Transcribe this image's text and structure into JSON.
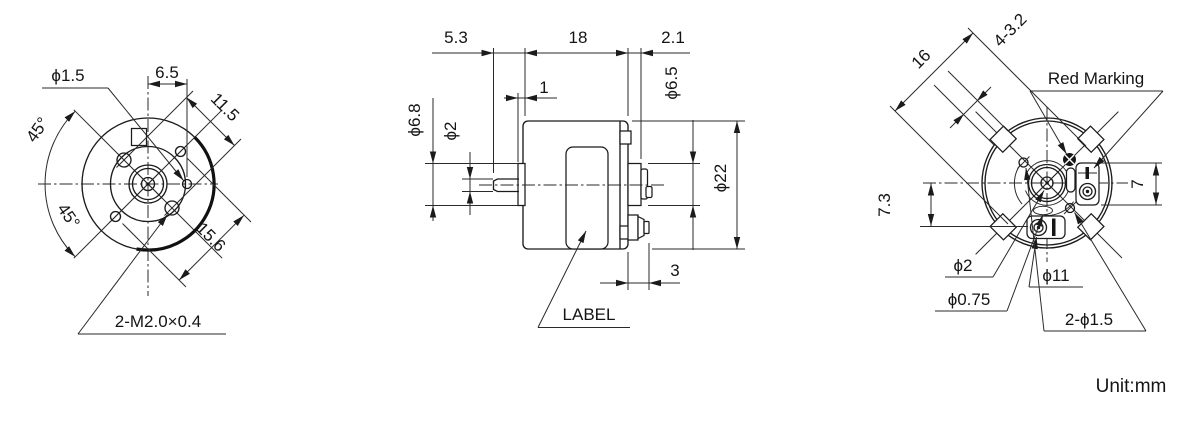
{
  "unit_note": "Unit:mm",
  "front_view": {
    "hole_dia": "ϕ1.5",
    "hole_offset": "6.5",
    "screw_circle": "11.5",
    "angle_upper": "45°",
    "angle_lower": "45°",
    "hole_circle": "15.6",
    "screw_thread": "2-M2.0×0.4"
  },
  "side_view": {
    "shaft_length": "5.3",
    "body_length": "18",
    "boss_length": "2.1",
    "bushing_length": "1",
    "bushing_dia": "ϕ6.8",
    "shaft_dia": "ϕ2",
    "boss_dia": "ϕ6.5",
    "body_dia": "ϕ22",
    "terminal_length": "3",
    "label_note": "LABEL"
  },
  "rear_view": {
    "slot_span": "16",
    "slot_spec": "4-3.2",
    "red_marking_note": "Red Marking",
    "terminal_height": "7",
    "terminal_offset": "7.3",
    "shaft_end_dia": "ϕ2",
    "pinhole_dia": "ϕ0.75",
    "terminal_circle_dia": "ϕ11",
    "marking_holes": "2-ϕ1.5"
  }
}
